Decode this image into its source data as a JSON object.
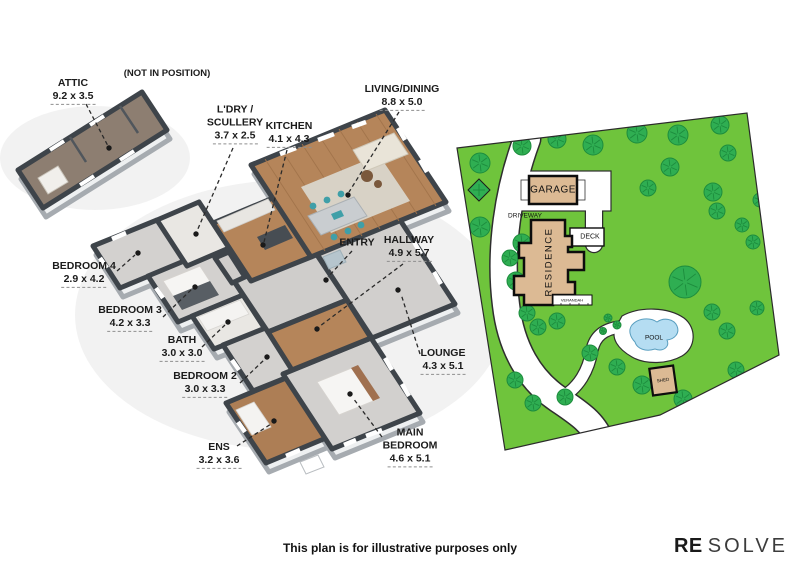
{
  "floor_plan": {
    "position_note": "(NOT IN POSITION)",
    "rooms": [
      {
        "name": "ATTIC",
        "dims": "9.2 x 3.5"
      },
      {
        "name": "L'DRY /",
        "name2": "SCULLERY",
        "dims": "3.7 x 2.5"
      },
      {
        "name": "KITCHEN",
        "dims": "4.1 x 4.3"
      },
      {
        "name": "LIVING/DINING",
        "dims": "8.8 x 5.0"
      },
      {
        "name": "ENTRY"
      },
      {
        "name": "HALLWAY",
        "dims": "4.9 x 5.7"
      },
      {
        "name": "BEDROOM 4",
        "dims": "2.9 x 4.2"
      },
      {
        "name": "BEDROOM 3",
        "dims": "4.2 x 3.3"
      },
      {
        "name": "BATH",
        "dims": "3.0 x 3.0"
      },
      {
        "name": "BEDROOM 2",
        "dims": "3.0 x 3.3"
      },
      {
        "name": "LOUNGE",
        "dims": "4.3 x 5.1"
      },
      {
        "name": "ENS",
        "dims": "3.2 x 3.6"
      },
      {
        "name": "MAIN",
        "name2": "BEDROOM",
        "dims": "4.6 x 5.1"
      }
    ]
  },
  "site_plan": {
    "garage": "GARAGE",
    "driveway": "DRIVEWAY",
    "deck": "DECK",
    "residence": "RESIDENCE",
    "verandah": "VERANDAH",
    "pool": "POOL",
    "shed": "SHED"
  },
  "footer": {
    "disclaimer": "This plan is for illustrative purposes only"
  },
  "brand": {
    "re": "RE",
    "solve": "SOLVE"
  },
  "colors": {
    "grass": "#6fc43c",
    "tree": "#2fae52",
    "building": "#dcba94",
    "pool_water": "#b5ddf2",
    "wall": "#3e444a",
    "wood_floor": "#b5855a",
    "carpet": "#d3d1cf"
  }
}
